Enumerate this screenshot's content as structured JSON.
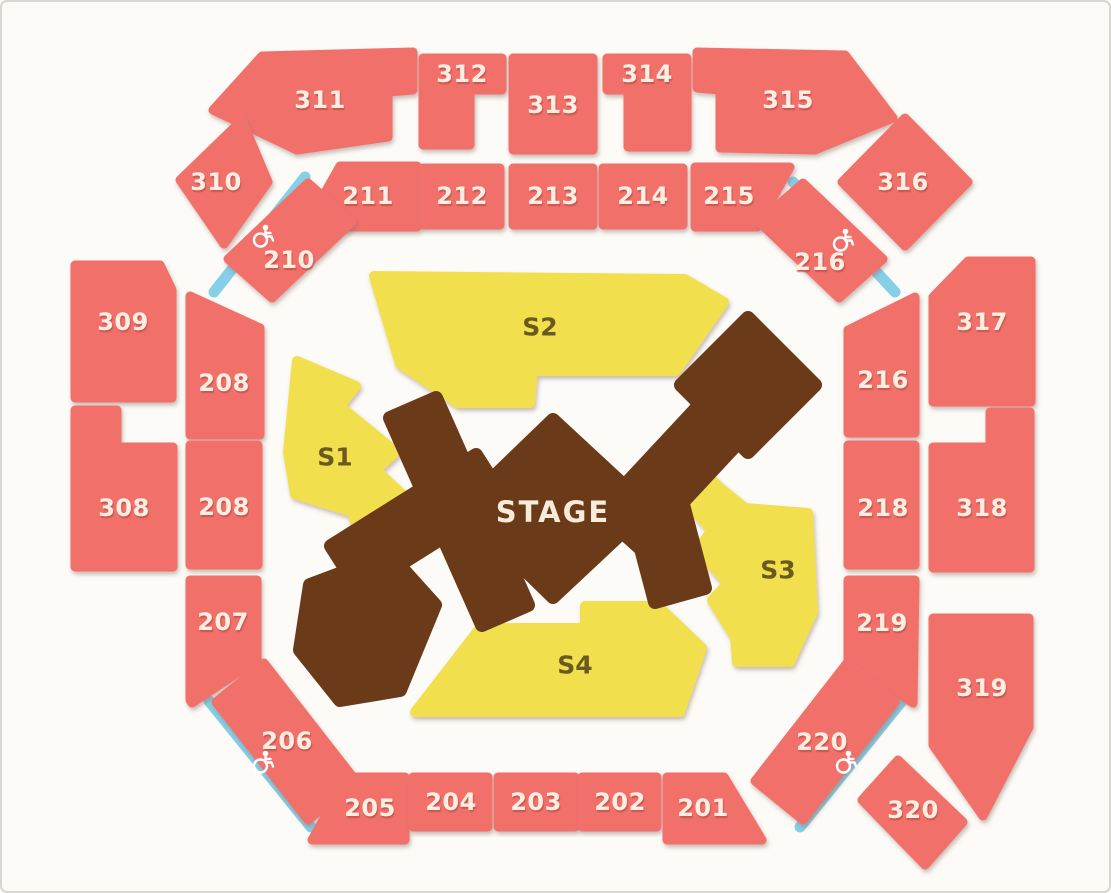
{
  "map": {
    "colors": {
      "background": "#fcfbf7",
      "section": "#f2706b",
      "floor": "#f2df4e",
      "stage": "#6b3a18",
      "access_strip": "#85cfe7",
      "label": "#fdeee2",
      "floor_label": "#6b5a20",
      "stage_label": "#f6ecd9"
    },
    "stage": {
      "label": "STAGE"
    },
    "floor_sections": {
      "s1": {
        "label": "S1"
      },
      "s2": {
        "label": "S2"
      },
      "s3": {
        "label": "S3"
      },
      "s4": {
        "label": "S4"
      }
    },
    "sections": {
      "311": {
        "label": "311"
      },
      "312": {
        "label": "312"
      },
      "313": {
        "label": "313"
      },
      "314": {
        "label": "314"
      },
      "315": {
        "label": "315"
      },
      "310": {
        "label": "310"
      },
      "316": {
        "label": "316"
      },
      "211": {
        "label": "211"
      },
      "212": {
        "label": "212"
      },
      "213": {
        "label": "213"
      },
      "214": {
        "label": "214"
      },
      "215": {
        "label": "215"
      },
      "210": {
        "label": "210"
      },
      "216d": {
        "label": "216"
      },
      "309": {
        "label": "309"
      },
      "317": {
        "label": "317"
      },
      "208u": {
        "label": "208"
      },
      "216r": {
        "label": "216"
      },
      "308": {
        "label": "308"
      },
      "318": {
        "label": "318"
      },
      "208l": {
        "label": "208"
      },
      "218": {
        "label": "218"
      },
      "207": {
        "label": "207"
      },
      "219": {
        "label": "219"
      },
      "319": {
        "label": "319"
      },
      "206": {
        "label": "206"
      },
      "220": {
        "label": "220"
      },
      "320": {
        "label": "320"
      },
      "205": {
        "label": "205"
      },
      "204": {
        "label": "204"
      },
      "203": {
        "label": "203"
      },
      "202": {
        "label": "202"
      },
      "201": {
        "label": "201"
      }
    },
    "accessibility": {
      "icon": "wheelchair",
      "marker_count": 4,
      "near_sections": [
        "210",
        "216",
        "206",
        "220"
      ]
    }
  }
}
